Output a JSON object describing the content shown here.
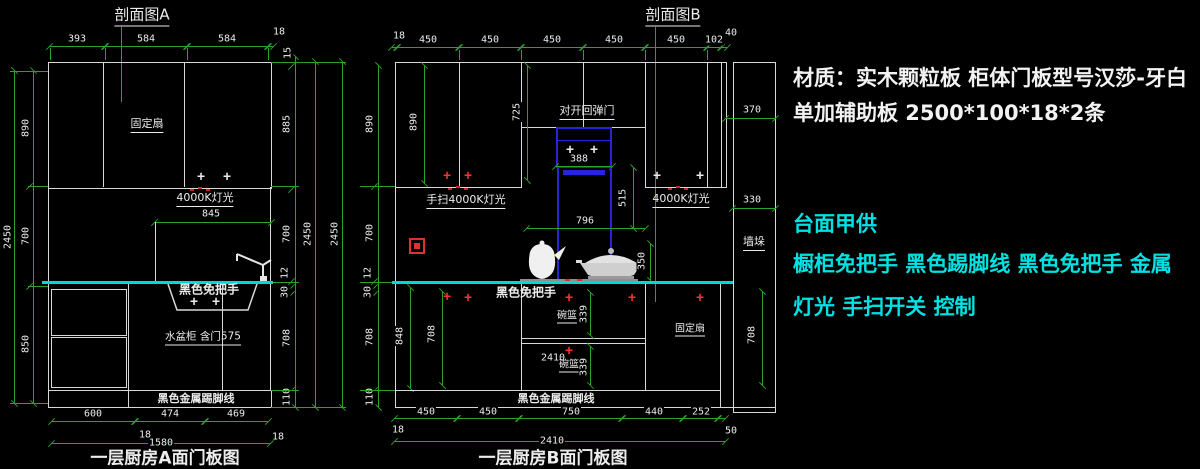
{
  "marks": {
    "plus": "+"
  },
  "colors": {
    "background": "#000000",
    "line": "#d8d8d8",
    "dimension": "#2aa32a",
    "counter": "#00d8d8",
    "hood": "#2626d8",
    "alert": "#ff3232",
    "note_cyan": "#00e2e2"
  },
  "notes": {
    "w1": "材质：实木颗粒板 柜体门板型号汉莎-牙白",
    "w2": "单加辅助板 2500*100*18*2条",
    "c1": "台面甲供",
    "c2": "橱柜免把手  黑色踢脚线 黑色免把手 金属",
    "c3": "灯光 手扫开关 控制"
  },
  "A": {
    "sec": "剖面图A",
    "title": "一层厨房A面门板图",
    "top": [
      "393",
      "584",
      "584",
      "18"
    ],
    "l2450": "2450",
    "l": [
      "890",
      "700",
      "850"
    ],
    "r": [
      "15",
      "885",
      "700",
      "12",
      "30",
      "708",
      "110"
    ],
    "r2450a": "2450",
    "r2450b": "2450",
    "d845": "845",
    "bot": [
      "600",
      "474",
      "469"
    ],
    "b18a": "18",
    "b18b": "18",
    "btotal": "1580",
    "fixed": "固定扇",
    "light": "4000K灯光",
    "handle": "黑色免把手",
    "sink": "水盆柜 含门575",
    "kick": "黑色金属踢脚线"
  },
  "B": {
    "sec": "剖面图B",
    "title": "一层厨房B面门板图",
    "top": [
      "18",
      "450",
      "450",
      "450",
      "450",
      "450",
      "102",
      "40"
    ],
    "l": [
      "890",
      "700",
      "12",
      "30",
      "708",
      "110"
    ],
    "inner": {
      "i890": "890",
      "i725": "725",
      "i388": "388",
      "i515": "515",
      "i796": "796",
      "i350": "350",
      "i848": "848",
      "i708": "708",
      "i339a": "339",
      "i339b": "339",
      "i2410": "2410"
    },
    "pier": {
      "p370": "370",
      "p330": "330",
      "name": "墙垛",
      "p708": "708"
    },
    "door": "对开回弹门",
    "handlight": "手扫4000K灯光",
    "light": "4000K灯光",
    "handle": "黑色免把手",
    "basket1": "碗篮",
    "basket2": "碗篮",
    "fixed": "固定扇",
    "kick": "黑色金属踢脚线",
    "bot": [
      "450",
      "450",
      "750",
      "440",
      "252"
    ],
    "b18": "18",
    "b50": "50",
    "btotal": "2410"
  }
}
